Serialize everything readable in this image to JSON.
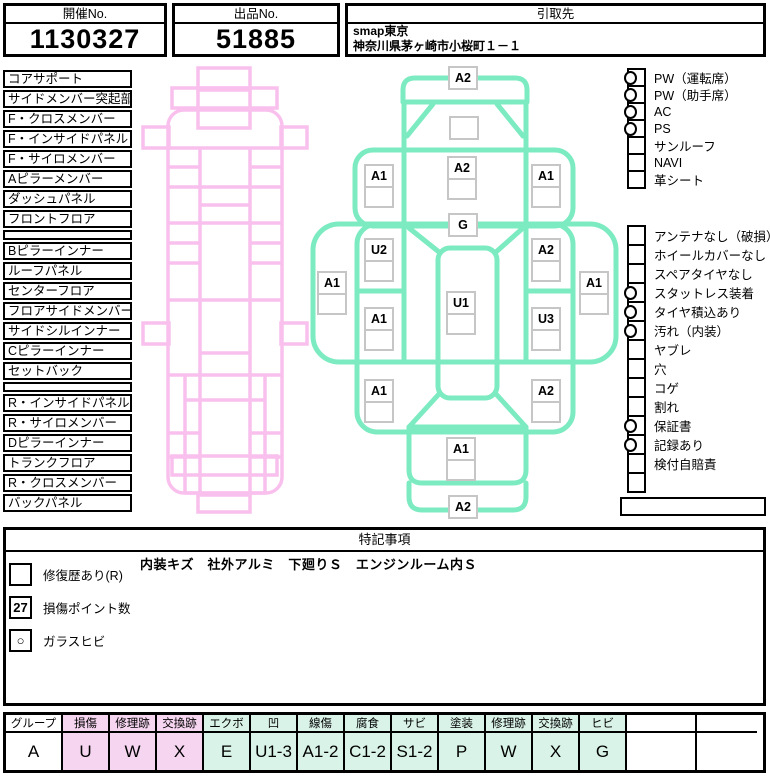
{
  "header": {
    "kaisai_label": "開催No.",
    "kaisai_value": "1130327",
    "shuppin_label": "出品No.",
    "shuppin_value": "51885",
    "hikitori_label": "引取先",
    "hikitori_line1": "smap東京",
    "hikitori_line2": "神奈川県茅ヶ崎市小桜町１－１"
  },
  "left_parts": [
    "コアサポート",
    "サイドメンバー突起部",
    "F・クロスメンバー",
    "F・インサイドパネル",
    "F・サイロメンバー",
    "Aピラーメンバー",
    "ダッシュパネル",
    "フロントフロア",
    "",
    "Bピラーインナー",
    "ルーフパネル",
    "センターフロア",
    "フロアサイドメンバー",
    "サイドシルインナー",
    "Cピラーインナー",
    "セットバック",
    "",
    "R・インサイドパネル",
    "R・サイロメンバー",
    "Dピラーインナー",
    "トランクフロア",
    "R・クロスメンバー",
    "バックパネル"
  ],
  "equipment": {
    "items": [
      {
        "label": "PW（運転席）",
        "checked": true
      },
      {
        "label": "PW（助手席）",
        "checked": true
      },
      {
        "label": "AC",
        "checked": true
      },
      {
        "label": "PS",
        "checked": true
      },
      {
        "label": "サンルーフ",
        "checked": false
      },
      {
        "label": "NAVI",
        "checked": false
      },
      {
        "label": "革シート",
        "checked": false
      }
    ]
  },
  "conditions": {
    "items": [
      {
        "label": "アンテナなし（破損）",
        "checked": false
      },
      {
        "label": "ホイールカバーなし",
        "checked": false
      },
      {
        "label": "スペアタイヤなし",
        "checked": false
      },
      {
        "label": "スタットレス装着",
        "checked": true
      },
      {
        "label": "タイヤ積込あり",
        "checked": true
      },
      {
        "label": "汚れ（内装）",
        "checked": true
      },
      {
        "label": "ヤブレ",
        "checked": false
      },
      {
        "label": "穴",
        "checked": false
      },
      {
        "label": "コゲ",
        "checked": false
      },
      {
        "label": "割れ",
        "checked": false
      },
      {
        "label": "保証書",
        "checked": true
      },
      {
        "label": "記録あり",
        "checked": true
      },
      {
        "label": "検付自賠責",
        "checked": false
      },
      {
        "label": "",
        "checked": false
      }
    ]
  },
  "car_diagram": {
    "markers": [
      {
        "code": "A2",
        "x": 448,
        "y": 66,
        "cells": 1
      },
      {
        "code": "",
        "x": 449,
        "y": 116,
        "cells": 1
      },
      {
        "code": "A1",
        "x": 364,
        "y": 164,
        "cells": 2
      },
      {
        "code": "A2",
        "x": 447,
        "y": 156,
        "cells": 2
      },
      {
        "code": "A1",
        "x": 531,
        "y": 164,
        "cells": 2
      },
      {
        "code": "G",
        "x": 448,
        "y": 213,
        "cells": 1
      },
      {
        "code": "U2",
        "x": 364,
        "y": 238,
        "cells": 2
      },
      {
        "code": "A2",
        "x": 531,
        "y": 238,
        "cells": 2
      },
      {
        "code": "A1",
        "x": 317,
        "y": 271,
        "cells": 2
      },
      {
        "code": "A1",
        "x": 579,
        "y": 271,
        "cells": 2
      },
      {
        "code": "U1",
        "x": 446,
        "y": 291,
        "cells": 2
      },
      {
        "code": "A1",
        "x": 364,
        "y": 307,
        "cells": 2
      },
      {
        "code": "U3",
        "x": 531,
        "y": 307,
        "cells": 2
      },
      {
        "code": "A1",
        "x": 364,
        "y": 379,
        "cells": 2
      },
      {
        "code": "A2",
        "x": 531,
        "y": 379,
        "cells": 2
      },
      {
        "code": "A1",
        "x": 446,
        "y": 437,
        "cells": 2
      },
      {
        "code": "A2",
        "x": 448,
        "y": 495,
        "cells": 1
      }
    ]
  },
  "notes": {
    "title": "特記事項",
    "remark": "内装キズ　社外アルミ　下廻りＳ　エンジンルーム内Ｓ",
    "legend": [
      {
        "box": "",
        "label": "修復歴あり(R)"
      },
      {
        "box": "27",
        "label": "損傷ポイント数"
      },
      {
        "box": "○",
        "label": "ガラスヒビ"
      }
    ]
  },
  "damage_legend": {
    "columns": [
      {
        "header": "グループ",
        "value": "A",
        "tint": "white"
      },
      {
        "header": "損傷",
        "value": "U",
        "tint": "pink"
      },
      {
        "header": "修理跡",
        "value": "W",
        "tint": "pink"
      },
      {
        "header": "交換跡",
        "value": "X",
        "tint": "pink"
      },
      {
        "header": "エクボ",
        "value": "E",
        "tint": "mint"
      },
      {
        "header": "凹",
        "value": "U1-3",
        "tint": "mint"
      },
      {
        "header": "線傷",
        "value": "A1-2",
        "tint": "mint"
      },
      {
        "header": "腐食",
        "value": "C1-2",
        "tint": "mint"
      },
      {
        "header": "サビ",
        "value": "S1-2",
        "tint": "mint"
      },
      {
        "header": "塗装",
        "value": "P",
        "tint": "mint"
      },
      {
        "header": "修理跡",
        "value": "W",
        "tint": "mint"
      },
      {
        "header": "交換跡",
        "value": "X",
        "tint": "mint"
      },
      {
        "header": "ヒビ",
        "value": "G",
        "tint": "mint"
      },
      {
        "header": "",
        "value": "",
        "tint": "white"
      },
      {
        "header": "",
        "value": "",
        "tint": "white"
      }
    ]
  },
  "colors": {
    "pink_line": "#f9c0ee",
    "green_line": "#7debc2",
    "cell_pink": "#f6d5f0",
    "cell_mint": "#d9f3e8",
    "cell_white": "#ffffff",
    "marker_border": "#c6c6c6"
  }
}
